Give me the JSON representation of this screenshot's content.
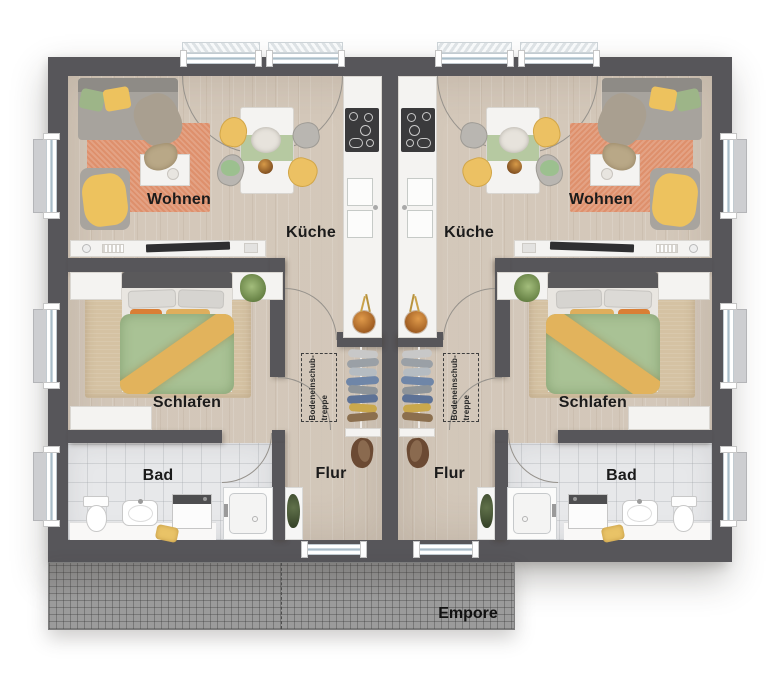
{
  "plan": {
    "type": "floor-plan",
    "description": "Duplex attic storey floor plan, two mirrored apartments",
    "left": {
      "living": "Wohnen",
      "kitchen": "Küche",
      "bedroom": "Schlafen",
      "bath": "Bad",
      "hall": "Flur",
      "loft_ladder": "Bodeneinschub-\ntreppe"
    },
    "right": {
      "living": "Wohnen",
      "kitchen": "Küche",
      "bedroom": "Schlafen",
      "bath": "Bad",
      "hall": "Flur",
      "loft_ladder": "Bodeneinschub-\ntreppe"
    },
    "gallery_label": "Empore"
  },
  "colors": {
    "wall": "#57565a",
    "wood_floor": "#d9cec1",
    "tile_floor": "#e7e8ea",
    "living_rug": "#de906c",
    "bedroom_rug": "#d5c2a3",
    "duvet_green": "#a9c295",
    "accent_yellow": "#ecc163",
    "counter_white": "#f4f3f1",
    "cooktop_black": "#3a3a3c",
    "empore_gray": "#9b9b9b"
  }
}
